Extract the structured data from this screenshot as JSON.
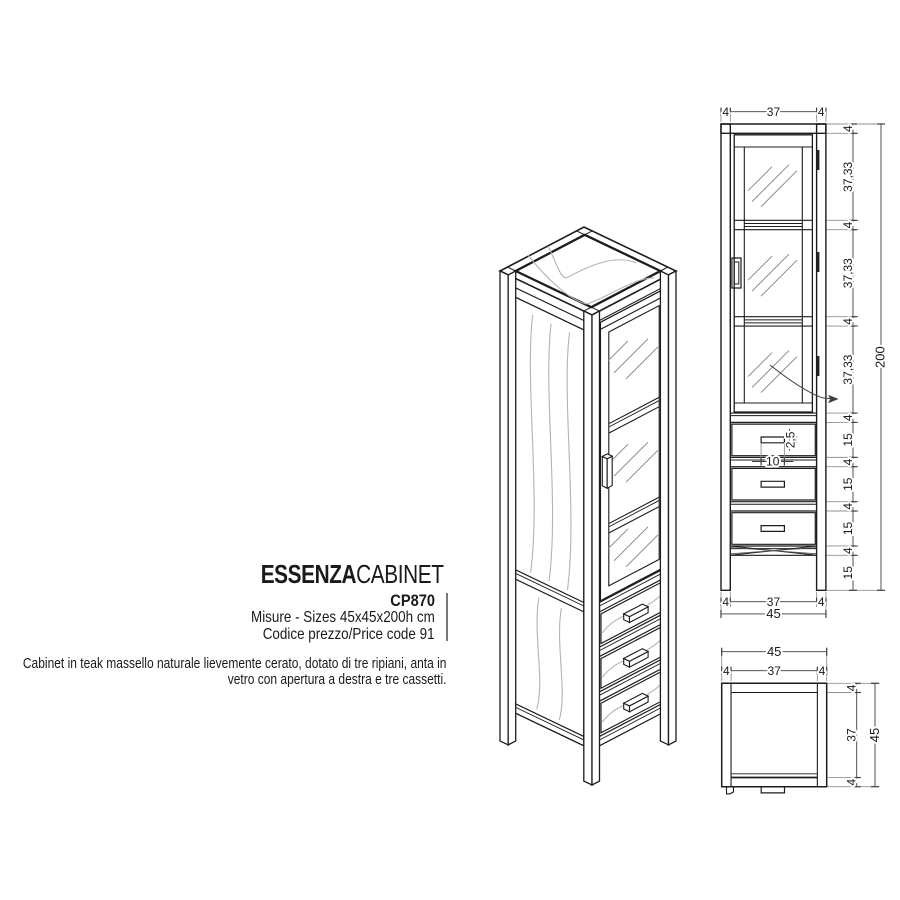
{
  "title_block": {
    "series": "ESSENZA",
    "type": "CABINET",
    "code": "CP870",
    "sizes_line": "Misure - Sizes 45x45x200h cm",
    "price_line": "Codice prezzo/Price code 91"
  },
  "description": {
    "line1": "Cabinet in teak massello naturale lievemente cerato, dotato di tre ripiani, anta in",
    "line2": "vetro con apertura a destra e tre cassetti."
  },
  "front_view": {
    "width_segments": [
      "4",
      "37",
      "4"
    ],
    "total_width": "45",
    "height_segments": [
      "4",
      "37,33",
      "4",
      "37,33",
      "4",
      "37,33",
      "4",
      "15",
      "4",
      "15",
      "4",
      "15",
      "4",
      "15"
    ],
    "total_height": "200",
    "handle_width": "10",
    "handle_height": "2,5"
  },
  "top_view": {
    "total_width": "45",
    "width_segments": [
      "4",
      "37",
      "4"
    ],
    "depth_segments": [
      "4",
      "37",
      "4"
    ],
    "total_depth": "45"
  },
  "colors": {
    "line": "#1c1c1c",
    "dim": "#3f3f3f",
    "ext": "#929292",
    "grain": "#b3b3b3",
    "glass": "#8a8a8a",
    "hinge": "#222222"
  }
}
